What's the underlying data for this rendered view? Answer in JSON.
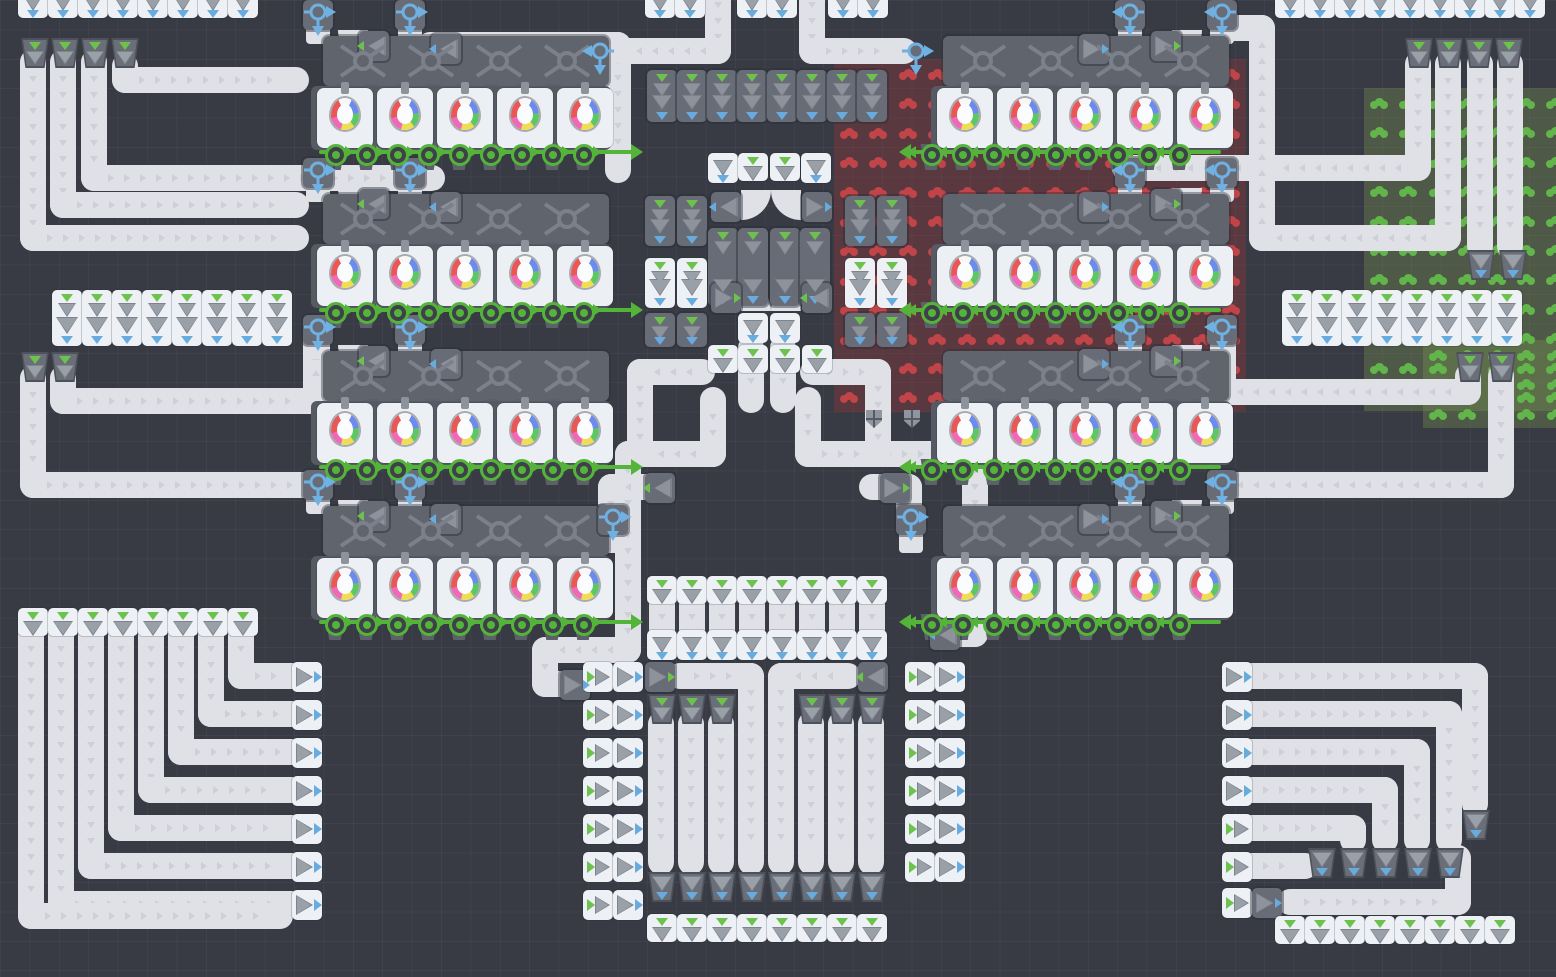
{
  "meta": {
    "app": "conveyor-factory-game-board",
    "canvas": {
      "w": 1556,
      "h": 977
    }
  },
  "palette": {
    "background": "#383b44",
    "grid_line": "rgba(255,255,255,0.035)",
    "belt": "#dfe1e6",
    "belt_chevron": "#cdd0d6",
    "tile_white": "#edf0f4",
    "tile_dark": "#686c76",
    "machine_strip": "#5a5e67",
    "arrow_gray": "#9aa0a8",
    "arrow_gray_dark": "#7e838c",
    "accent_green": "#6dc24d",
    "accent_blue": "#68acdf",
    "pipe_green": "#54b43a",
    "pipe_blue": "#6fb1e3",
    "patch_red_cell": "rgba(158,52,60,0.34)",
    "patch_red_blob": "#c04448",
    "patch_green_cell": "rgba(128,158,82,0.30)",
    "patch_green_blob": "#62b54a",
    "orb_colors": [
      "#ea5757",
      "#ef6ab4",
      "#6b8cec",
      "#5dc763",
      "#eede56",
      "#f7f7f7"
    ]
  },
  "board": {
    "cell": 29.4
  },
  "patches": [
    {
      "kind": "red",
      "x": 834,
      "y": 59,
      "cols": 14,
      "rows": 12
    },
    {
      "kind": "green",
      "x": 1364,
      "y": 88,
      "cols": 7,
      "rows": 11
    },
    {
      "kind": "green",
      "x": 1423,
      "y": 340,
      "cols": 5,
      "rows": 3
    }
  ],
  "clusters": [
    {
      "x": 295,
      "y": 0,
      "dir": "r"
    },
    {
      "x": 295,
      "y": 158,
      "dir": "r"
    },
    {
      "x": 295,
      "y": 315,
      "dir": "r"
    },
    {
      "x": 295,
      "y": 470,
      "dir": "r"
    },
    {
      "x": 915,
      "y": 0,
      "dir": "l"
    },
    {
      "x": 915,
      "y": 158,
      "dir": "l"
    },
    {
      "x": 915,
      "y": 315,
      "dir": "l"
    },
    {
      "x": 915,
      "y": 470,
      "dir": "l"
    }
  ],
  "belts": [
    {
      "pts": [
        [
          33,
          62
        ],
        [
          33,
          238
        ],
        [
          296,
          238
        ]
      ]
    },
    {
      "pts": [
        [
          63,
          62
        ],
        [
          63,
          205
        ],
        [
          296,
          205
        ]
      ]
    },
    {
      "pts": [
        [
          94,
          62
        ],
        [
          94,
          178
        ],
        [
          432,
          178
        ]
      ]
    },
    {
      "pts": [
        [
          125,
          66
        ],
        [
          125,
          80
        ],
        [
          296,
          80
        ]
      ]
    },
    {
      "pts": [
        [
          430,
          45
        ],
        [
          618,
          45
        ],
        [
          618,
          170
        ]
      ]
    },
    {
      "pts": [
        [
          718,
          -12
        ],
        [
          718,
          51
        ],
        [
          622,
          51
        ]
      ]
    },
    {
      "pts": [
        [
          812,
          -12
        ],
        [
          812,
          51
        ],
        [
          904,
          51
        ]
      ]
    },
    {
      "pts": [
        [
          33,
          378
        ],
        [
          33,
          485
        ],
        [
          316,
          485
        ]
      ]
    },
    {
      "pts": [
        [
          63,
          378
        ],
        [
          63,
          401
        ],
        [
          316,
          401
        ],
        [
          316,
          340
        ]
      ]
    },
    {
      "pts": [
        [
          713,
          400
        ],
        [
          713,
          454
        ],
        [
          628,
          454
        ],
        [
          628,
          650
        ],
        [
          545,
          650
        ],
        [
          545,
          684
        ],
        [
          560,
          684
        ]
      ]
    },
    {
      "pts": [
        [
          808,
          400
        ],
        [
          808,
          454
        ],
        [
          975,
          454
        ],
        [
          975,
          634
        ],
        [
          954,
          634
        ]
      ]
    },
    {
      "pts": [
        [
          702,
          372
        ],
        [
          640,
          372
        ],
        [
          640,
          450
        ]
      ]
    },
    {
      "pts": [
        [
          813,
          372
        ],
        [
          878,
          372
        ],
        [
          878,
          450
        ]
      ]
    },
    {
      "pts": [
        [
          648,
          487
        ],
        [
          611,
          487
        ],
        [
          611,
          518
        ]
      ]
    },
    {
      "pts": [
        [
          872,
          487
        ],
        [
          909,
          487
        ],
        [
          909,
          518
        ]
      ]
    },
    {
      "pts": [
        [
          751,
          348
        ],
        [
          751,
          400
        ]
      ]
    },
    {
      "pts": [
        [
          783,
          348
        ],
        [
          783,
          400
        ]
      ]
    },
    {
      "pts": [
        [
          662,
          600
        ],
        [
          662,
          634
        ]
      ]
    },
    {
      "pts": [
        [
          692,
          600
        ],
        [
          692,
          634
        ]
      ]
    },
    {
      "pts": [
        [
          722,
          600
        ],
        [
          722,
          634
        ]
      ]
    },
    {
      "pts": [
        [
          752,
          600
        ],
        [
          752,
          634
        ]
      ]
    },
    {
      "pts": [
        [
          782,
          600
        ],
        [
          782,
          634
        ]
      ]
    },
    {
      "pts": [
        [
          812,
          600
        ],
        [
          812,
          634
        ]
      ]
    },
    {
      "pts": [
        [
          842,
          600
        ],
        [
          842,
          634
        ]
      ]
    },
    {
      "pts": [
        [
          872,
          600
        ],
        [
          872,
          634
        ]
      ]
    },
    {
      "pts": [
        [
          680,
          676
        ],
        [
          751,
          676
        ],
        [
          751,
          862
        ]
      ]
    },
    {
      "pts": [
        [
          848,
          676
        ],
        [
          781,
          676
        ],
        [
          781,
          862
        ]
      ]
    },
    {
      "pts": [
        [
          661,
          724
        ],
        [
          661,
          862
        ]
      ]
    },
    {
      "pts": [
        [
          691,
          724
        ],
        [
          691,
          862
        ]
      ]
    },
    {
      "pts": [
        [
          721,
          724
        ],
        [
          721,
          862
        ]
      ]
    },
    {
      "pts": [
        [
          811,
          724
        ],
        [
          811,
          862
        ]
      ]
    },
    {
      "pts": [
        [
          841,
          724
        ],
        [
          841,
          862
        ]
      ]
    },
    {
      "pts": [
        [
          871,
          724
        ],
        [
          871,
          862
        ]
      ]
    },
    {
      "pts": [
        [
          241,
          632
        ],
        [
          241,
          676
        ],
        [
          292,
          676
        ]
      ]
    },
    {
      "pts": [
        [
          211,
          632
        ],
        [
          211,
          714
        ],
        [
          292,
          714
        ]
      ]
    },
    {
      "pts": [
        [
          181,
          632
        ],
        [
          181,
          752
        ],
        [
          292,
          752
        ]
      ]
    },
    {
      "pts": [
        [
          151,
          632
        ],
        [
          151,
          790
        ],
        [
          292,
          790
        ]
      ]
    },
    {
      "pts": [
        [
          121,
          632
        ],
        [
          121,
          828
        ],
        [
          292,
          828
        ]
      ]
    },
    {
      "pts": [
        [
          91,
          632
        ],
        [
          91,
          866
        ],
        [
          292,
          866
        ]
      ]
    },
    {
      "pts": [
        [
          61,
          632
        ],
        [
          61,
          904
        ],
        [
          292,
          904
        ]
      ]
    },
    {
      "pts": [
        [
          31,
          632
        ],
        [
          31,
          916
        ],
        [
          280,
          916
        ]
      ]
    },
    {
      "pts": [
        [
          1249,
          676
        ],
        [
          1475,
          676
        ],
        [
          1475,
          804
        ]
      ]
    },
    {
      "pts": [
        [
          1249,
          714
        ],
        [
          1449,
          714
        ],
        [
          1449,
          840
        ]
      ]
    },
    {
      "pts": [
        [
          1249,
          752
        ],
        [
          1417,
          752
        ],
        [
          1417,
          840
        ]
      ]
    },
    {
      "pts": [
        [
          1249,
          790
        ],
        [
          1385,
          790
        ],
        [
          1385,
          840
        ]
      ]
    },
    {
      "pts": [
        [
          1249,
          828
        ],
        [
          1353,
          828
        ],
        [
          1353,
          840
        ]
      ]
    },
    {
      "pts": [
        [
          1249,
          866
        ],
        [
          1305,
          866
        ]
      ]
    },
    {
      "pts": [
        [
          1290,
          902
        ],
        [
          1458,
          902
        ],
        [
          1458,
          858
        ]
      ]
    },
    {
      "pts": [
        [
          1418,
          64
        ],
        [
          1418,
          168
        ],
        [
          1125,
          168
        ]
      ]
    },
    {
      "pts": [
        [
          1448,
          64
        ],
        [
          1448,
          238
        ],
        [
          1262,
          238
        ],
        [
          1262,
          28
        ],
        [
          1234,
          28
        ]
      ]
    },
    {
      "pts": [
        [
          1480,
          64
        ],
        [
          1480,
          246
        ]
      ]
    },
    {
      "pts": [
        [
          1510,
          64
        ],
        [
          1510,
          246
        ]
      ]
    },
    {
      "pts": [
        [
          1468,
          376
        ],
        [
          1468,
          392
        ],
        [
          1223,
          392
        ],
        [
          1223,
          340
        ]
      ]
    },
    {
      "pts": [
        [
          1501,
          376
        ],
        [
          1501,
          485
        ],
        [
          1223,
          485
        ]
      ]
    }
  ],
  "tiles": [
    {
      "t": "port_v",
      "x": 18,
      "y": -12,
      "n": 8,
      "dx": 30
    },
    {
      "t": "port_v",
      "x": 645,
      "y": -12,
      "n": 2,
      "dx": 30
    },
    {
      "t": "port_v",
      "x": 737,
      "y": -12,
      "n": 2,
      "dx": 30
    },
    {
      "t": "port_v",
      "x": 828,
      "y": -12,
      "n": 2,
      "dx": 30
    },
    {
      "t": "port_v",
      "x": 1275,
      "y": -12,
      "n": 9,
      "dx": 30
    },
    {
      "t": "collector",
      "x": 20,
      "y": 38,
      "n": 4,
      "dx": 30
    },
    {
      "t": "collector",
      "x": 1404,
      "y": 38,
      "n": 4,
      "dx": 30
    },
    {
      "t": "filter_v",
      "x": 52,
      "y": 290,
      "n": 8,
      "dx": 30
    },
    {
      "t": "filter_v",
      "x": 1282,
      "y": 290,
      "n": 8,
      "dx": 30
    },
    {
      "t": "collector",
      "x": 20,
      "y": 352
    },
    {
      "t": "collector",
      "x": 50,
      "y": 352
    },
    {
      "t": "collector",
      "x": 1455,
      "y": 352
    },
    {
      "t": "collector",
      "x": 1487,
      "y": 352
    },
    {
      "t": "dfunnel",
      "x": 647,
      "y": 70,
      "n": 8,
      "dx": 30,
      "h": 52
    },
    {
      "t": "port_v",
      "x": 708,
      "y": 153
    },
    {
      "t": "intake_v",
      "x": 738,
      "y": 153
    },
    {
      "t": "intake_v",
      "x": 770,
      "y": 153
    },
    {
      "t": "port_v",
      "x": 801,
      "y": 153
    },
    {
      "t": "launcher",
      "x": 711,
      "y": 192,
      "dir": "l",
      "accent": "blue"
    },
    {
      "t": "curveq",
      "x": 741,
      "y": 190,
      "corner": "br"
    },
    {
      "t": "curveq",
      "x": 771,
      "y": 190,
      "corner": "bl"
    },
    {
      "t": "launcher",
      "x": 802,
      "y": 192,
      "dir": "r",
      "accent": "blue"
    },
    {
      "t": "dfunnel",
      "x": 645,
      "y": 196,
      "h": 50
    },
    {
      "t": "dfunnel",
      "x": 677,
      "y": 196,
      "h": 50
    },
    {
      "t": "dfunnel",
      "x": 845,
      "y": 196,
      "h": 50
    },
    {
      "t": "dfunnel",
      "x": 877,
      "y": 196,
      "h": 50
    },
    {
      "t": "dfunnel",
      "x": 708,
      "y": 228,
      "h": 78
    },
    {
      "t": "dfunnel",
      "x": 738,
      "y": 228,
      "h": 78
    },
    {
      "t": "dfunnel",
      "x": 770,
      "y": 228,
      "h": 78
    },
    {
      "t": "dfunnel",
      "x": 800,
      "y": 228,
      "h": 78
    },
    {
      "t": "filter_v",
      "x": 645,
      "y": 258,
      "h": 50
    },
    {
      "t": "filter_v",
      "x": 677,
      "y": 258,
      "h": 50
    },
    {
      "t": "filter_v",
      "x": 845,
      "y": 258,
      "h": 50
    },
    {
      "t": "filter_v",
      "x": 877,
      "y": 258,
      "h": 50
    },
    {
      "t": "launcher",
      "x": 711,
      "y": 283,
      "dir": "r",
      "accent": "green"
    },
    {
      "t": "curveq",
      "x": 741,
      "y": 281,
      "corner": "tr"
    },
    {
      "t": "curveq",
      "x": 771,
      "y": 281,
      "corner": "tl"
    },
    {
      "t": "launcher",
      "x": 802,
      "y": 283,
      "dir": "l",
      "accent": "green"
    },
    {
      "t": "port_v",
      "x": 738,
      "y": 313
    },
    {
      "t": "port_v",
      "x": 770,
      "y": 313
    },
    {
      "t": "dfunnel",
      "x": 645,
      "y": 313,
      "h": 34
    },
    {
      "t": "dfunnel",
      "x": 677,
      "y": 313,
      "h": 34
    },
    {
      "t": "dfunnel",
      "x": 845,
      "y": 313,
      "h": 34
    },
    {
      "t": "dfunnel",
      "x": 877,
      "y": 313,
      "h": 34
    },
    {
      "t": "intake_v",
      "x": 708,
      "y": 345
    },
    {
      "t": "intake_v",
      "x": 738,
      "y": 345
    },
    {
      "t": "intake_v",
      "x": 770,
      "y": 345
    },
    {
      "t": "intake_v",
      "x": 802,
      "y": 345
    },
    {
      "t": "shield",
      "x": 866,
      "y": 410
    },
    {
      "t": "shield",
      "x": 904,
      "y": 410
    },
    {
      "t": "launcher",
      "x": 645,
      "y": 473,
      "dir": "l",
      "accent": "green"
    },
    {
      "t": "launcher",
      "x": 880,
      "y": 473,
      "dir": "r",
      "accent": "green"
    },
    {
      "t": "tower",
      "x": 598,
      "y": 505
    },
    {
      "t": "tower",
      "x": 896,
      "y": 505
    },
    {
      "t": "launcher",
      "x": 560,
      "y": 670,
      "dir": "r",
      "accent": "blue"
    },
    {
      "t": "launcher",
      "x": 930,
      "y": 620,
      "dir": "l",
      "accent": "blue"
    },
    {
      "t": "intake_v",
      "x": 647,
      "y": 576,
      "n": 8,
      "dx": 30
    },
    {
      "t": "port_v",
      "x": 647,
      "y": 630,
      "n": 8,
      "dx": 30
    },
    {
      "t": "launcher",
      "x": 645,
      "y": 662,
      "dir": "r",
      "accent": "green"
    },
    {
      "t": "launcher",
      "x": 858,
      "y": 662,
      "dir": "l",
      "accent": "green"
    },
    {
      "t": "collector",
      "x": 647,
      "y": 694,
      "n": 3,
      "dx": 30
    },
    {
      "t": "collector",
      "x": 797,
      "y": 694,
      "n": 3,
      "dx": 30
    },
    {
      "t": "planter",
      "x": 647,
      "y": 872,
      "n": 8,
      "dx": 30
    },
    {
      "t": "intake_v",
      "x": 647,
      "y": 914,
      "n": 8,
      "dx": 30
    },
    {
      "t": "pair_h",
      "x": 583,
      "y": 662,
      "n": 7,
      "dy": 38
    },
    {
      "t": "pair_h",
      "x": 905,
      "y": 662,
      "n": 6,
      "dy": 38
    },
    {
      "t": "intake_v",
      "x": 18,
      "y": 608,
      "n": 8,
      "dx": 30
    },
    {
      "t": "port_h",
      "x": 292,
      "y": 662,
      "n": 7,
      "dy": 38
    },
    {
      "t": "port_h",
      "x": 1222,
      "y": 662,
      "n": 4,
      "dy": 38
    },
    {
      "t": "intake_h",
      "x": 1222,
      "y": 814
    },
    {
      "t": "intake_h",
      "x": 1222,
      "y": 852
    },
    {
      "t": "intake_h",
      "x": 1222,
      "y": 888
    },
    {
      "t": "launcher",
      "x": 1252,
      "y": 888,
      "dir": "r",
      "accent": "blue"
    },
    {
      "t": "planter",
      "x": 1307,
      "y": 848,
      "n": 5,
      "dx": 32
    },
    {
      "t": "planter",
      "x": 1461,
      "y": 810
    },
    {
      "t": "intake_v",
      "x": 1275,
      "y": 916,
      "n": 8,
      "dx": 30
    },
    {
      "t": "planter",
      "x": 1466,
      "y": 250
    },
    {
      "t": "planter",
      "x": 1498,
      "y": 250
    }
  ],
  "bnodes": [
    {
      "x": 600,
      "y": 51,
      "dir": "l"
    },
    {
      "x": 916,
      "y": 51,
      "dir": "r"
    }
  ]
}
